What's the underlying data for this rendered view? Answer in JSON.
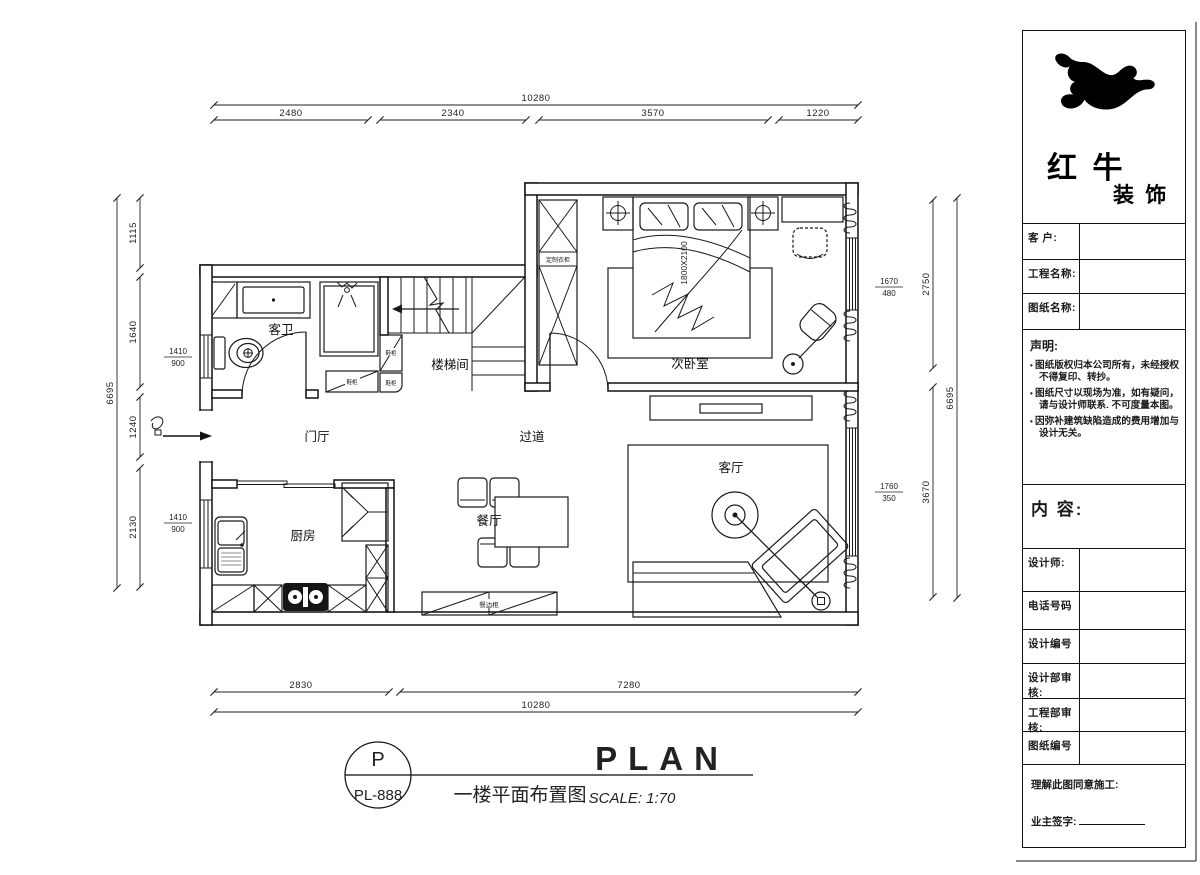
{
  "colors": {
    "ink": "#1a1a1a",
    "paper": "#ffffff"
  },
  "plan": {
    "rooms": {
      "bath": "客卫",
      "stair": "楼梯间",
      "bedroom": "次卧室",
      "foyer": "门厅",
      "corridor": "过道",
      "dining": "餐厅",
      "kitchen": "厨房",
      "living": "客厅"
    },
    "furniture": {
      "wardrobe": "定制衣柜",
      "shoe": "鞋柜",
      "sideboard": "餐边柜",
      "bed_size": "1800X2100"
    }
  },
  "dims": {
    "top_total": "10280",
    "top": [
      "2480",
      "2340",
      "3570",
      "1220"
    ],
    "bottom": [
      "2830",
      "7280"
    ],
    "bottom_total": "10280",
    "left_total": "6695",
    "left": [
      "1115",
      "1640",
      "1240",
      "2130"
    ],
    "right_total": "6695",
    "right": [
      "2750",
      "3670"
    ],
    "win_left_1": {
      "num": "1410",
      "den": "900"
    },
    "win_left_2": {
      "num": "1410",
      "den": "900"
    },
    "win_right_1": {
      "num": "1670",
      "den": "480"
    },
    "win_right_2": {
      "num": "1760",
      "den": "350"
    }
  },
  "drawing_title": {
    "bubble_top": "P",
    "bubble_bottom": "PL-888",
    "name_cn": "一楼平面布置图",
    "name_en": "PLAN",
    "scale": "SCALE: 1:70"
  },
  "title_block": {
    "brand": {
      "name_top": "红 牛",
      "name_bottom": "装 饰"
    },
    "fields": {
      "client": "客 户:",
      "project": "工程名称:",
      "drawing": "图纸名称:"
    },
    "statement_title": "声明:",
    "statement_items": [
      "图纸版权归本公司所有，未经授权不得复印、转抄。",
      "图纸尺寸以现场为准，如有疑问，请与设计师联系. 不可度量本图。",
      "因弥补建筑缺陷造成的费用增加与设计无关。"
    ],
    "content_label": "内 容:",
    "rows": {
      "designer": "设计师:",
      "phone": "电话号码",
      "design_no": "设计编号",
      "design_review": "设计部审核:",
      "eng_review": "工程部审核:",
      "drawing_no": "图纸编号"
    },
    "approval_line": "理解此图同意施工:",
    "signature_label": "业主签字:"
  }
}
